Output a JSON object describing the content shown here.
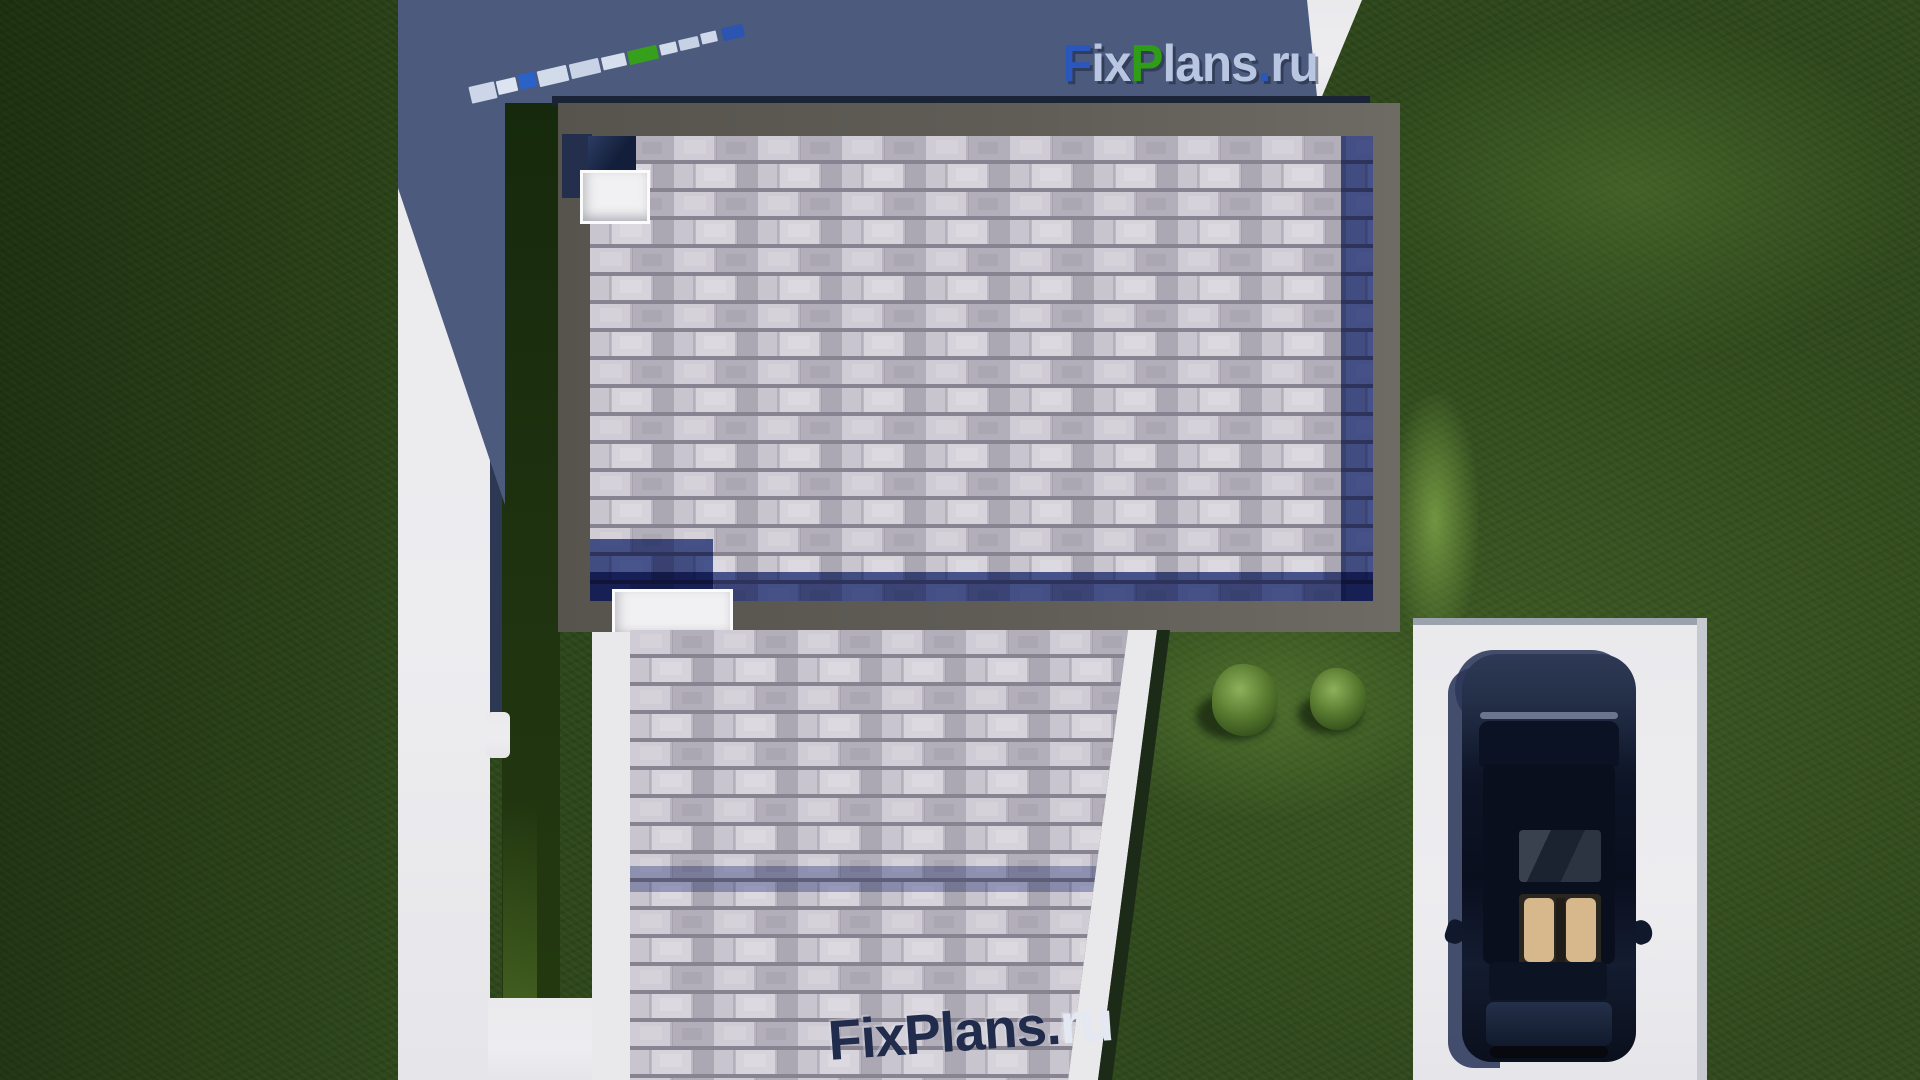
{
  "branding": {
    "site_name": "FixPlans.ru",
    "top_logo": {
      "parts": [
        {
          "text": "F",
          "color": "#2a57bd"
        },
        {
          "text": "ix",
          "color": "#b9c6e2"
        },
        {
          "text": "P",
          "color": "#2f9d15"
        },
        {
          "text": "lans",
          "color": "#b9c6e2"
        },
        {
          "text": ".",
          "color": "#2a57bd"
        },
        {
          "text": "ru",
          "color": "#b9c6e2"
        }
      ]
    },
    "bottom_watermark": {
      "parts": [
        {
          "text": "FixPlans",
          "color": "#212b4c"
        },
        {
          "text": ".",
          "color": "#212b4c"
        },
        {
          "text": "ru",
          "color": "#e3e8f2"
        }
      ]
    }
  },
  "palette": {
    "grass": "#2d461a",
    "grass_shadowed": "#1f3310",
    "concrete": "#ebebee",
    "shadow_blue": "#4c5a7d",
    "roof_parapet_gray": "#5f5b55",
    "shingle_light": "#c9c6ce",
    "shingle_shadow_navy": "#2e3a5e",
    "lower_parapet_white": "#e9e9ec",
    "car_body": "#0d1627",
    "car_interior_tan": "#d2b186",
    "bush_green": "#5c7f38"
  }
}
